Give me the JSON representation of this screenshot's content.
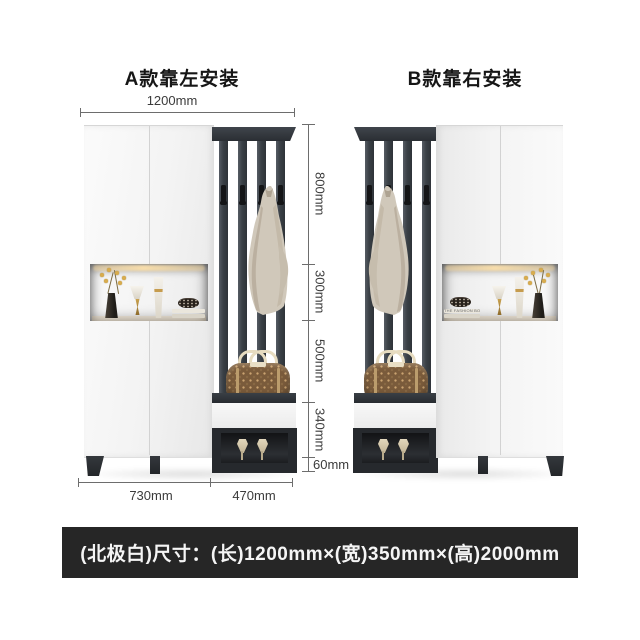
{
  "titles": {
    "model_a": "A款靠左安装",
    "model_b": "B款靠右安装"
  },
  "dims": {
    "top_width": "1200mm",
    "vertical": [
      "800mm",
      "300mm",
      "500mm",
      "340mm",
      "60mm"
    ],
    "bottom": [
      "730mm",
      "470mm"
    ]
  },
  "caption": {
    "text": "(北极白)尺寸：(长)1200mm×(宽)350mm×(高)2000mm"
  },
  "decor": {
    "book_spine": "THE FASHION BOOK"
  },
  "colors": {
    "caption_bg": "#262626",
    "furniture_dark": "#383d43",
    "panel_white": "#f4f4f4",
    "warm_light": "#f0cf97",
    "bag_brown": "#7a5b3b",
    "coat_beige": "#d0c8ba"
  }
}
